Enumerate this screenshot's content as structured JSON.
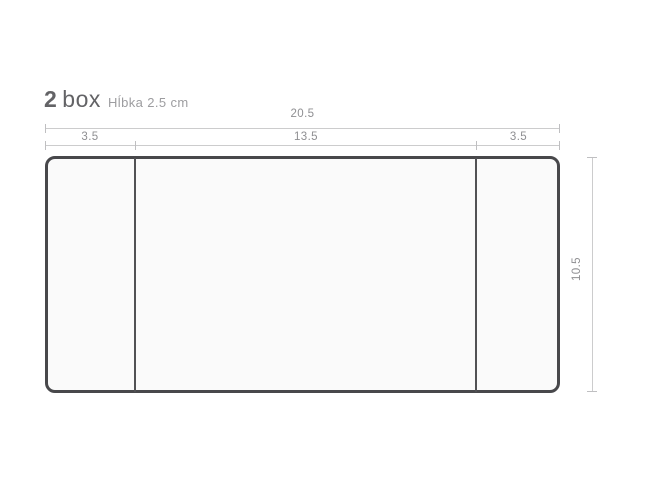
{
  "title": {
    "number": "2",
    "word": "box"
  },
  "subtitle": "Hĺbka 2.5 cm",
  "dimensions": {
    "unit": "cm",
    "total_width": "20.5",
    "segments": [
      "3.5",
      "13.5",
      "3.5"
    ],
    "height": "10.5"
  },
  "colors": {
    "background": "#ffffff",
    "box_fill": "#fafafa",
    "box_outline": "#48484b",
    "divider": "#515154",
    "dimension_line": "#cccccd",
    "dimension_text": "#8f8f92",
    "title_text": "#636366",
    "subtitle_text": "#9d9da0"
  }
}
